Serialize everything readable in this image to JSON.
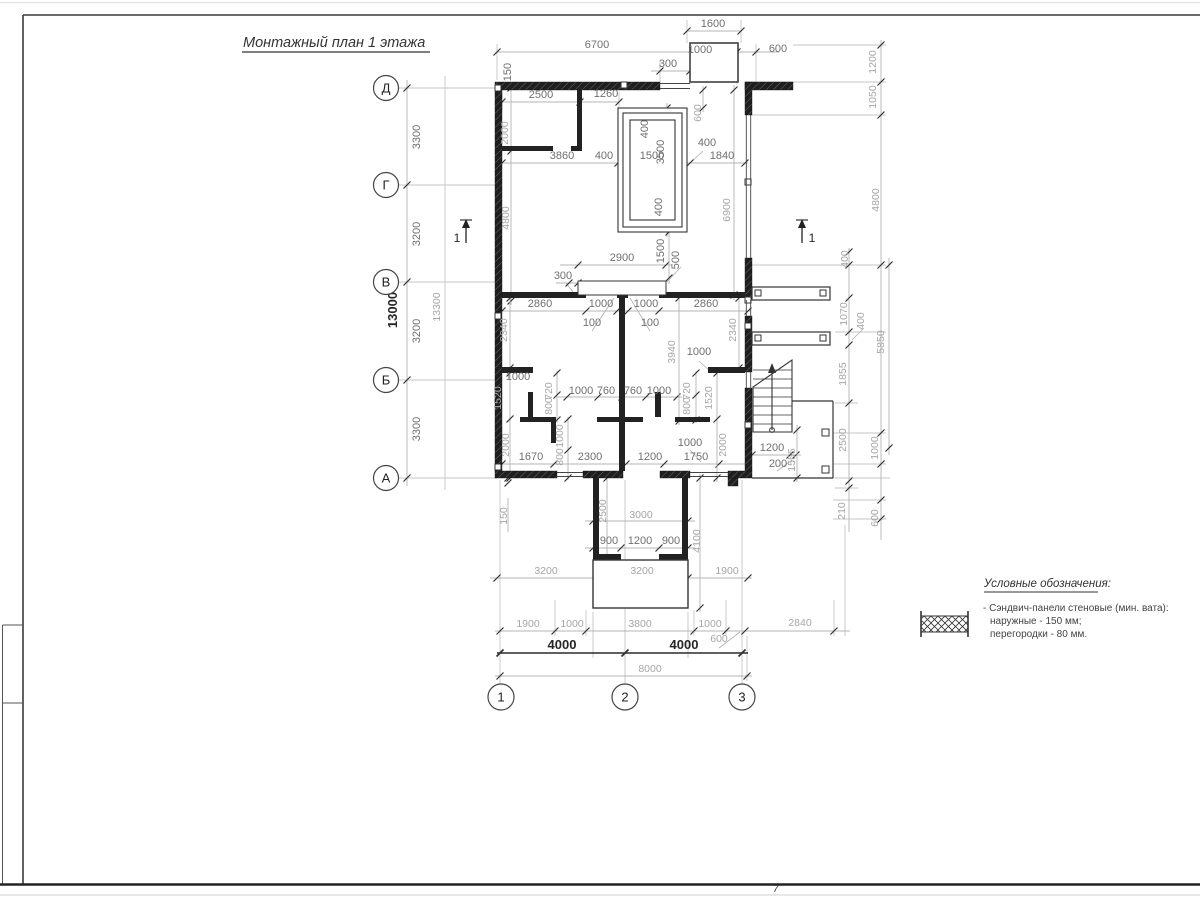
{
  "title": "Монтажный план 1 этажа",
  "sheet_number": "7",
  "legend": {
    "heading": "Условные обозначения:",
    "items": [
      {
        "symbol": "sandwich-panel-hatch",
        "lines": [
          "- Сэндвич-панели стеновые (мин. вата):",
          "наружные - 150 мм;",
          "перегородки - 80 мм."
        ]
      }
    ]
  },
  "axes": {
    "rows": [
      {
        "label": "Д",
        "x": 386,
        "y": 88
      },
      {
        "label": "Г",
        "x": 386,
        "y": 185
      },
      {
        "label": "В",
        "x": 386,
        "y": 282
      },
      {
        "label": "Б",
        "x": 386,
        "y": 380
      },
      {
        "label": "А",
        "x": 386,
        "y": 478
      }
    ],
    "cols": [
      {
        "label": "1",
        "x": 501,
        "y": 697
      },
      {
        "label": "2",
        "x": 625,
        "y": 697
      },
      {
        "label": "3",
        "x": 742,
        "y": 697
      }
    ]
  },
  "section_marks": [
    {
      "label": "1",
      "tx": 457,
      "ty": 242,
      "ax": 466
    },
    {
      "label": "1",
      "tx": 812,
      "ty": 242,
      "ax": 802
    }
  ],
  "dimensions": [
    {
      "t": "1600",
      "x": 713,
      "y": 27,
      "r": 0,
      "c": "d"
    },
    {
      "t": "6700",
      "x": 597,
      "y": 48,
      "r": 0,
      "c": "d"
    },
    {
      "t": "1000",
      "x": 700,
      "y": 53,
      "r": 0,
      "c": "d"
    },
    {
      "t": "600",
      "x": 778,
      "y": 52,
      "r": 0,
      "c": "d"
    },
    {
      "t": "300",
      "x": 668,
      "y": 67,
      "r": 0,
      "c": "d"
    },
    {
      "t": "150",
      "x": 511,
      "y": 72,
      "r": -90,
      "c": "d"
    },
    {
      "t": "2500",
      "x": 541,
      "y": 98,
      "r": 0,
      "c": "d"
    },
    {
      "t": "1260",
      "x": 606,
      "y": 97,
      "r": 0,
      "c": "d"
    },
    {
      "t": "2000",
      "x": 508,
      "y": 133,
      "r": -90,
      "c": "l"
    },
    {
      "t": "600",
      "x": 701,
      "y": 113,
      "r": -90,
      "c": "l"
    },
    {
      "t": "400",
      "x": 648,
      "y": 129,
      "r": -90,
      "c": "d"
    },
    {
      "t": "3500",
      "x": 664,
      "y": 152,
      "r": -90,
      "c": "d"
    },
    {
      "t": "400",
      "x": 604,
      "y": 159,
      "r": 0,
      "c": "d"
    },
    {
      "t": "1500",
      "x": 652,
      "y": 159,
      "r": 0,
      "c": "d"
    },
    {
      "t": "400",
      "x": 707,
      "y": 146,
      "r": 0,
      "c": "d"
    },
    {
      "t": "1840",
      "x": 722,
      "y": 159,
      "r": 0,
      "c": "d"
    },
    {
      "t": "3860",
      "x": 562,
      "y": 159,
      "r": 0,
      "c": "d"
    },
    {
      "t": "6900",
      "x": 730,
      "y": 210,
      "r": -90,
      "c": "l"
    },
    {
      "t": "4800",
      "x": 509,
      "y": 218,
      "r": -90,
      "c": "l"
    },
    {
      "t": "400",
      "x": 662,
      "y": 207,
      "r": -90,
      "c": "d"
    },
    {
      "t": "2900",
      "x": 622,
      "y": 261,
      "r": 0,
      "c": "d"
    },
    {
      "t": "1500",
      "x": 664,
      "y": 251,
      "r": -90,
      "c": "d"
    },
    {
      "t": "500",
      "x": 679,
      "y": 260,
      "r": -90,
      "c": "d"
    },
    {
      "t": "300",
      "x": 563,
      "y": 279,
      "r": 0,
      "c": "d"
    },
    {
      "t": "2860",
      "x": 540,
      "y": 307,
      "r": 0,
      "c": "d"
    },
    {
      "t": "1000",
      "x": 601,
      "y": 307,
      "r": 0,
      "c": "d"
    },
    {
      "t": "1000",
      "x": 646,
      "y": 307,
      "r": 0,
      "c": "d"
    },
    {
      "t": "2860",
      "x": 706,
      "y": 307,
      "r": 0,
      "c": "d"
    },
    {
      "t": "100",
      "x": 592,
      "y": 326,
      "r": 0,
      "c": "d"
    },
    {
      "t": "100",
      "x": 650,
      "y": 326,
      "r": 0,
      "c": "d"
    },
    {
      "t": "2340",
      "x": 507,
      "y": 330,
      "r": -90,
      "c": "l"
    },
    {
      "t": "2340",
      "x": 736,
      "y": 330,
      "r": -90,
      "c": "l"
    },
    {
      "t": "3940",
      "x": 675,
      "y": 352,
      "r": -90,
      "c": "l"
    },
    {
      "t": "1000",
      "x": 699,
      "y": 355,
      "r": 0,
      "c": "d"
    },
    {
      "t": "1000",
      "x": 518,
      "y": 380,
      "r": 0,
      "c": "d"
    },
    {
      "t": "1520",
      "x": 501,
      "y": 398,
      "r": -90,
      "c": "l"
    },
    {
      "t": "720",
      "x": 552,
      "y": 391,
      "r": -90,
      "c": "l"
    },
    {
      "t": "800",
      "x": 552,
      "y": 406,
      "r": -90,
      "c": "l"
    },
    {
      "t": "1000",
      "x": 563,
      "y": 436,
      "r": -90,
      "c": "l"
    },
    {
      "t": "800",
      "x": 563,
      "y": 457,
      "r": -90,
      "c": "l"
    },
    {
      "t": "720",
      "x": 690,
      "y": 391,
      "r": -90,
      "c": "l"
    },
    {
      "t": "800",
      "x": 690,
      "y": 406,
      "r": -90,
      "c": "l"
    },
    {
      "t": "1520",
      "x": 712,
      "y": 398,
      "r": -90,
      "c": "l"
    },
    {
      "t": "2000",
      "x": 509,
      "y": 445,
      "r": -90,
      "c": "l"
    },
    {
      "t": "2000",
      "x": 726,
      "y": 445,
      "r": -90,
      "c": "l"
    },
    {
      "t": "1000",
      "x": 581,
      "y": 394,
      "r": 0,
      "c": "d"
    },
    {
      "t": "760",
      "x": 606,
      "y": 394,
      "r": 0,
      "c": "d"
    },
    {
      "t": "760",
      "x": 633,
      "y": 394,
      "r": 0,
      "c": "d"
    },
    {
      "t": "1000",
      "x": 659,
      "y": 394,
      "r": 0,
      "c": "d"
    },
    {
      "t": "1670",
      "x": 531,
      "y": 460,
      "r": 0,
      "c": "d"
    },
    {
      "t": "2300",
      "x": 590,
      "y": 460,
      "r": 0,
      "c": "d"
    },
    {
      "t": "1200",
      "x": 650,
      "y": 460,
      "r": 0,
      "c": "d"
    },
    {
      "t": "1750",
      "x": 696,
      "y": 460,
      "r": 0,
      "c": "d"
    },
    {
      "t": "1000",
      "x": 690,
      "y": 446,
      "r": 0,
      "c": "d"
    },
    {
      "t": "1200",
      "x": 772,
      "y": 451,
      "r": 0,
      "c": "d"
    },
    {
      "t": "200",
      "x": 778,
      "y": 467,
      "r": 0,
      "c": "d"
    },
    {
      "t": "1555",
      "x": 795,
      "y": 460,
      "r": -90,
      "c": "l"
    },
    {
      "t": "150",
      "x": 507,
      "y": 516,
      "r": -90,
      "c": "l"
    },
    {
      "t": "2500",
      "x": 606,
      "y": 511,
      "r": -90,
      "c": "l"
    },
    {
      "t": "3000",
      "x": 641,
      "y": 518,
      "r": 0,
      "c": "l"
    },
    {
      "t": "900",
      "x": 609,
      "y": 544,
      "r": 0,
      "c": "d"
    },
    {
      "t": "1200",
      "x": 640,
      "y": 544,
      "r": 0,
      "c": "d"
    },
    {
      "t": "900",
      "x": 671,
      "y": 544,
      "r": 0,
      "c": "d"
    },
    {
      "t": "4100",
      "x": 700,
      "y": 541,
      "r": -90,
      "c": "l"
    },
    {
      "t": "3200",
      "x": 546,
      "y": 574,
      "r": 0,
      "c": "l"
    },
    {
      "t": "3200",
      "x": 642,
      "y": 574,
      "r": 0,
      "c": "l"
    },
    {
      "t": "1900",
      "x": 727,
      "y": 574,
      "r": 0,
      "c": "l"
    },
    {
      "t": "1900",
      "x": 528,
      "y": 627,
      "r": 0,
      "c": "l"
    },
    {
      "t": "1000",
      "x": 572,
      "y": 627,
      "r": 0,
      "c": "l"
    },
    {
      "t": "3800",
      "x": 640,
      "y": 627,
      "r": 0,
      "c": "l"
    },
    {
      "t": "1000",
      "x": 710,
      "y": 627,
      "r": 0,
      "c": "l"
    },
    {
      "t": "2840",
      "x": 800,
      "y": 626,
      "r": 0,
      "c": "l"
    },
    {
      "t": "600",
      "x": 719,
      "y": 642,
      "r": 0,
      "c": "l"
    },
    {
      "t": "4000",
      "x": 562,
      "y": 649,
      "r": 0,
      "c": "b"
    },
    {
      "t": "4000",
      "x": 684,
      "y": 649,
      "r": 0,
      "c": "b"
    },
    {
      "t": "8000",
      "x": 650,
      "y": 672,
      "r": 0,
      "c": "l"
    },
    {
      "t": "1200",
      "x": 876,
      "y": 62,
      "r": -90,
      "c": "l"
    },
    {
      "t": "1050",
      "x": 876,
      "y": 97,
      "r": -90,
      "c": "l"
    },
    {
      "t": "4800",
      "x": 879,
      "y": 200,
      "r": -90,
      "c": "l"
    },
    {
      "t": "400",
      "x": 848,
      "y": 259,
      "r": -90,
      "c": "l"
    },
    {
      "t": "1070",
      "x": 847,
      "y": 314,
      "r": -90,
      "c": "l"
    },
    {
      "t": "400",
      "x": 864,
      "y": 321,
      "r": -90,
      "c": "l"
    },
    {
      "t": "5850",
      "x": 884,
      "y": 342,
      "r": -90,
      "c": "l"
    },
    {
      "t": "1855",
      "x": 846,
      "y": 374,
      "r": -90,
      "c": "l"
    },
    {
      "t": "2500",
      "x": 846,
      "y": 440,
      "r": -90,
      "c": "l"
    },
    {
      "t": "1000",
      "x": 878,
      "y": 448,
      "r": -90,
      "c": "l"
    },
    {
      "t": "210",
      "x": 845,
      "y": 511,
      "r": -90,
      "c": "l"
    },
    {
      "t": "600",
      "x": 878,
      "y": 518,
      "r": -90,
      "c": "l"
    },
    {
      "t": "3300",
      "x": 420,
      "y": 137,
      "r": -90,
      "c": "d"
    },
    {
      "t": "3200",
      "x": 420,
      "y": 234,
      "r": -90,
      "c": "d"
    },
    {
      "t": "3200",
      "x": 420,
      "y": 331,
      "r": -90,
      "c": "d"
    },
    {
      "t": "3300",
      "x": 420,
      "y": 429,
      "r": -90,
      "c": "d"
    },
    {
      "t": "13000",
      "x": 397,
      "y": 310,
      "r": -90,
      "c": "b"
    },
    {
      "t": "13300",
      "x": 440,
      "y": 307,
      "r": -90,
      "c": "l"
    }
  ]
}
